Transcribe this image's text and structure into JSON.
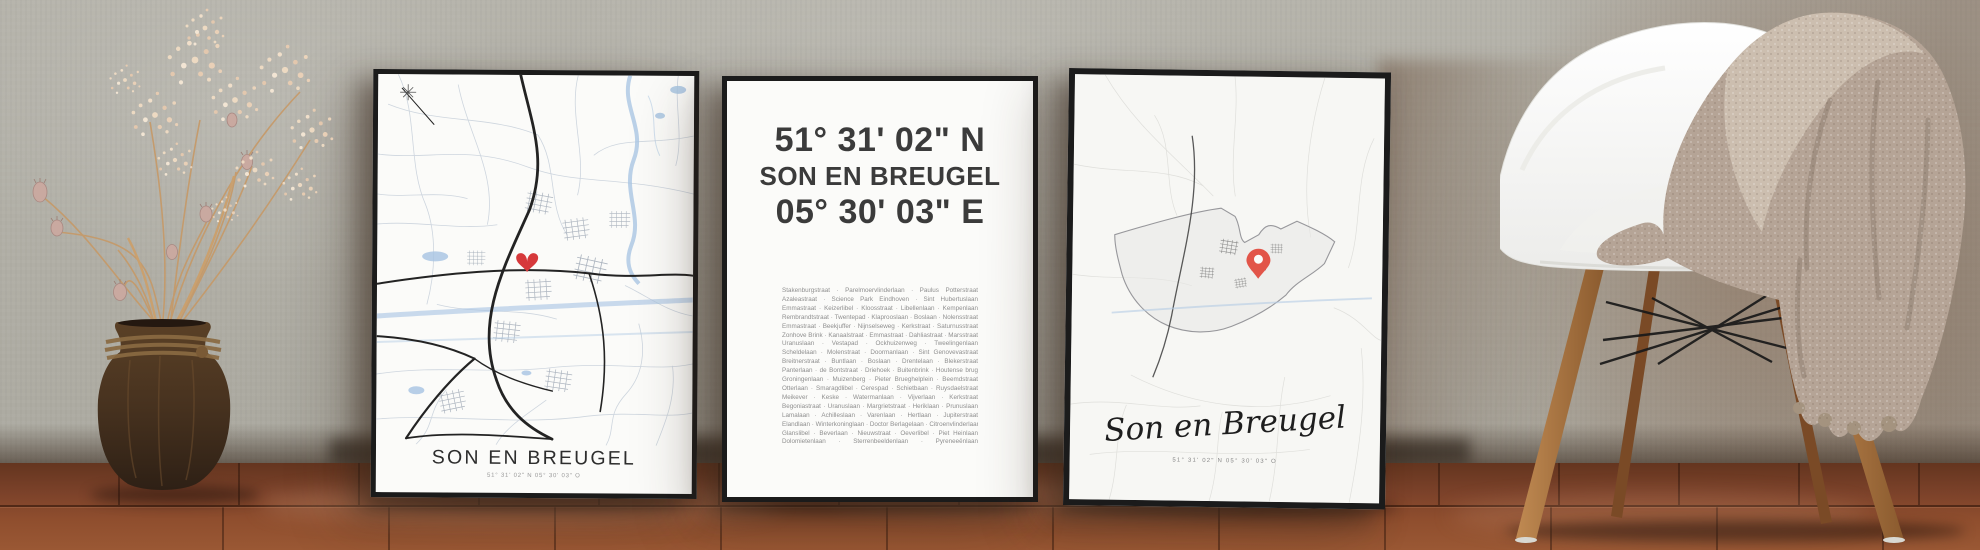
{
  "posters": {
    "left": {
      "title": "SON EN BREUGEL",
      "coordinates_small": "51° 31' 02\" N 05° 30' 03\" O",
      "marker_icon": "heart-icon"
    },
    "middle": {
      "latitude": "51° 31' 02\" N",
      "city": "SON EN BREUGEL",
      "longitude": "05° 30' 03\" E",
      "streets": [
        "Stakenburgstraat · Parelmoervlinderlaan · Paulus Potterstraat",
        "Azaleastraat · Science Park Eindhoven · Sint Hubertuslaan",
        "Emmastraat · Keizerlibel · Kloosstraat · Libellenlaan · Kempenlaan",
        "Rembrandtstraat · Twentepad · Klaprooslaan · Boslaan · Nolensstraat",
        "Emmastraat · Beekjuffer · Nijnselseweg · Kerkstraat · Saturnusstraat",
        "Zonhove Brink · Kanaalstraat · Emmastraat · Dahliastraat · Marsstraat",
        "Uranuslaan · Vestapad · Ockhuizenweg · Tweelingenlaan",
        "Scheldelaan · Molenstraat · Doormanlaan · Sint Genovevastraat",
        "Breitnerstraat · Buntlaan · Boslaan · Drentelaan · Blekerstraat",
        "Panterlaan · de Bontstraat · Driehoek · Buitenbrink · Houtense brug",
        "Groningenlaan · Muizenberg · Pieter Brueghelplein · Beemdstraat",
        "Otterlaan · Smaragdlibel · Cerespad · Schietbaan · Ruysdaelstraat",
        "Meikever · Keske · Watermanlaan · Vijverlaan · Kerkstraat",
        "Begoniastraat · Uranuslaan · Margrietstraat · Heriklaan · Prunuslaan",
        "Lamalaan · Achilleslaan · Varenlaan · Hertlaan · Jupiterstraat",
        "Elandlaan · Winterkoninglaan · Doctor Berlagelaan · Citroenvlinderlaan",
        "Glanslibel · Beverlaan · Nieuwstraat · Oeverlibel · Piet Heinlaan",
        "Dolomietenlaan · Sterrenbeeldenlaan · Pyreneeënlaan"
      ]
    },
    "right": {
      "title_script": "Son en Breugel",
      "coordinates_small": "51° 31' 02\" N 05° 30' 03\" O",
      "marker_icon": "location-pin-icon"
    }
  },
  "colors": {
    "frame": "#1b1b1b",
    "poster-bg": "#fbfbf9",
    "wall": "#b6b4ab",
    "floor-mid": "#7c422a",
    "heart-red": "#d6393b",
    "pin-red": "#e25549",
    "map-road": "#232323",
    "map-street": "#c6cfda",
    "map-water": "#a6c3e2",
    "text-dark": "#3b3b3b",
    "text-gray": "#8f8f8f"
  }
}
